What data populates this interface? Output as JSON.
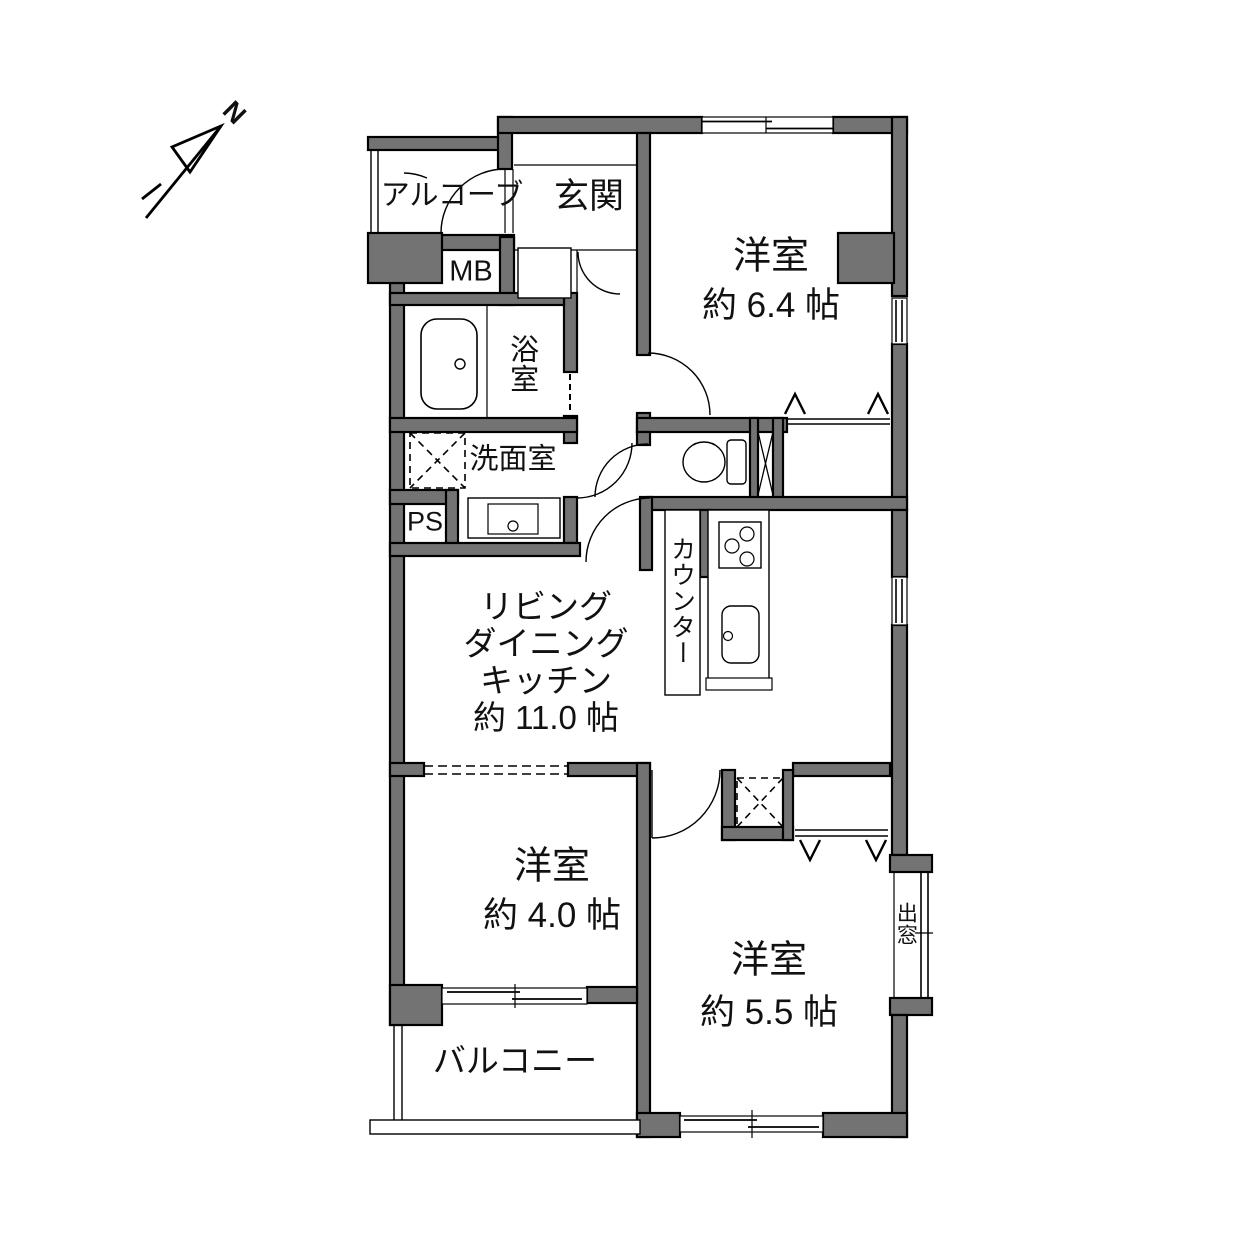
{
  "colors": {
    "wall_fill": "#737373",
    "line": "#000000",
    "background": "#ffffff"
  },
  "compass": {
    "north_label": "N"
  },
  "rooms": {
    "alcove": {
      "label": "アルコーブ"
    },
    "entrance": {
      "label": "玄関"
    },
    "bedroom1": {
      "name": "洋室",
      "size": "約 6.4 帖"
    },
    "meter_box": {
      "label": "MB"
    },
    "bathroom": {
      "label": "浴室"
    },
    "washroom": {
      "label": "洗面室"
    },
    "pipe_space": {
      "label": "PS"
    },
    "ldk": {
      "line1": "リビング",
      "line2": "ダイニング",
      "line3": "キッチン",
      "size": "約 11.0 帖"
    },
    "counter": {
      "label": "カウンター"
    },
    "bedroom2": {
      "name": "洋室",
      "size": "約 4.0 帖"
    },
    "bedroom3": {
      "name": "洋室",
      "size": "約 5.5 帖"
    },
    "bay_window": {
      "label": "出窓"
    },
    "balcony": {
      "label": "バルコニー"
    }
  }
}
